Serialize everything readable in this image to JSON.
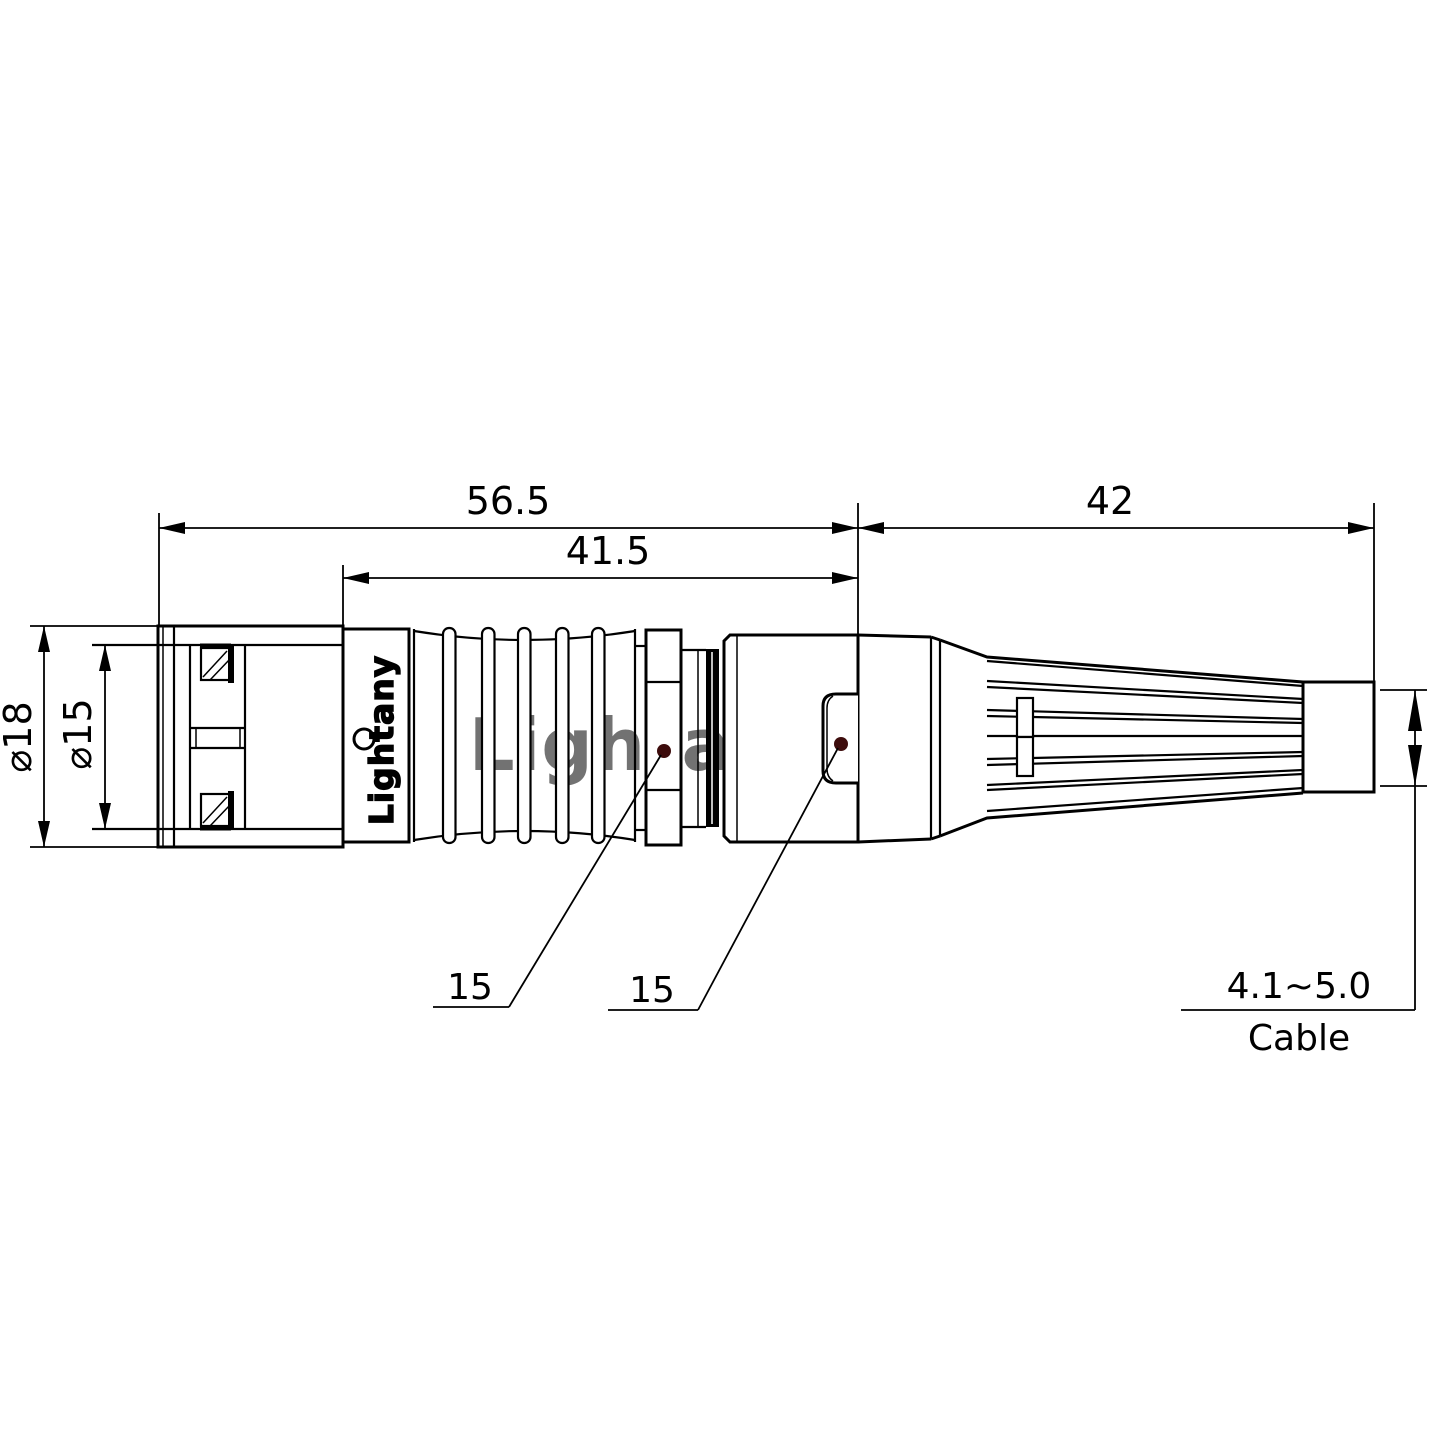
{
  "drawing": {
    "watermark": "Lightany",
    "brand": "Lightany",
    "dims": {
      "total_length": "56.5",
      "body_length": "41.5",
      "boot_length": "42",
      "outer_diameter": "⌀18",
      "inner_diameter": "⌀15",
      "cable_range": "4.1~5.0",
      "cable_label": "Cable"
    },
    "callouts": [
      "15",
      "15"
    ],
    "colors": {
      "line": "#000000",
      "watermark_pink": "#efb9b9",
      "callout_dot": "#3d0c0c",
      "background": "#ffffff"
    }
  }
}
